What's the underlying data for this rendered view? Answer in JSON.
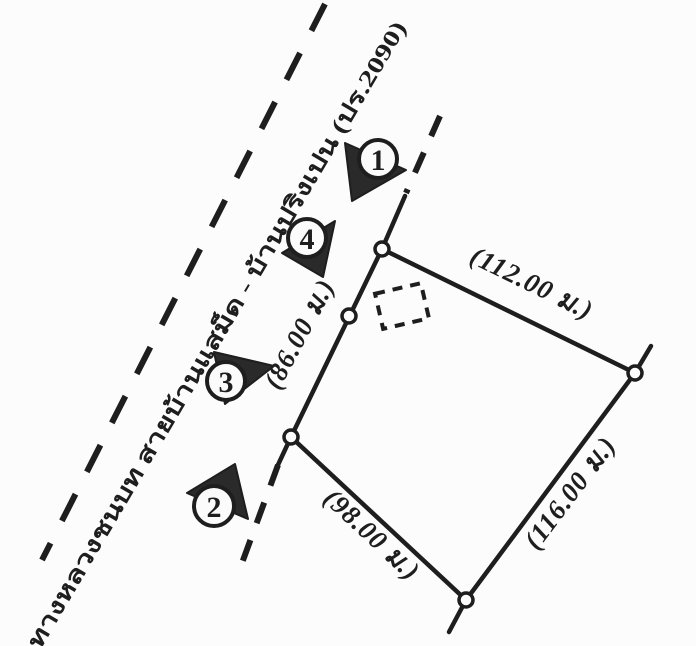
{
  "road": {
    "name_label": "ทางหลวงชนบท สายบ้านแสม็ด - บ้านปริงเปน (ปร.2090)"
  },
  "markers": [
    {
      "label": "1"
    },
    {
      "label": "2"
    },
    {
      "label": "3"
    },
    {
      "label": "4"
    }
  ],
  "parcel": {
    "side_north_label": "(112.00 ม.)",
    "side_east_label": "(116.00 ม.)",
    "side_south_label": "(98.00 ม.)",
    "side_west_label": "(86.00 ม.)"
  },
  "colors": {
    "ink": "#1e1e1e",
    "paper": "#fcfcfc"
  }
}
